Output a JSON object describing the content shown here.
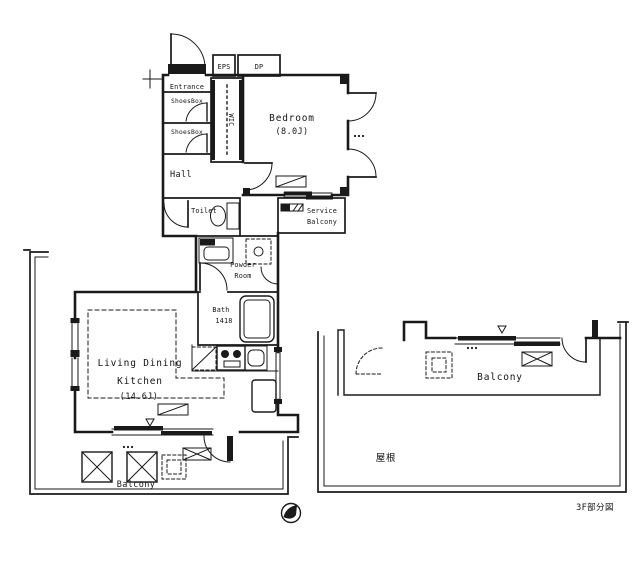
{
  "plan": {
    "title": "apartment-floor-plan",
    "colors": {
      "line": "#1a1a1a",
      "background": "#ffffff"
    },
    "rooms": {
      "entrance": {
        "label": "Entrance"
      },
      "shoes_box_upper": {
        "label": "ShoesBox"
      },
      "shoes_box_lower": {
        "label": "ShoesBox"
      },
      "wic": {
        "label": "WIC"
      },
      "eps": {
        "label": "EPS"
      },
      "dp": {
        "label": "DP"
      },
      "bedroom": {
        "label": "Bedroom",
        "size": "(8.0J)"
      },
      "hall": {
        "label": "Hall"
      },
      "toilet": {
        "label": "Toilet"
      },
      "service_balcony": {
        "label_line1": "Service",
        "label_line2": "Balcony"
      },
      "powder_room": {
        "label_line1": "Powder",
        "label_line2": "Room"
      },
      "bath": {
        "label": "Bath",
        "size": "1418"
      },
      "ldk": {
        "label_line1": "Living Dining",
        "label_line2": "Kitchen",
        "size": "(14.6J)"
      },
      "balcony_southwest": {
        "label": "Balcony"
      },
      "balcony_southeast": {
        "label": "Balcony"
      },
      "roof": {
        "label": "屋根"
      }
    },
    "caption": "3F部分図"
  }
}
